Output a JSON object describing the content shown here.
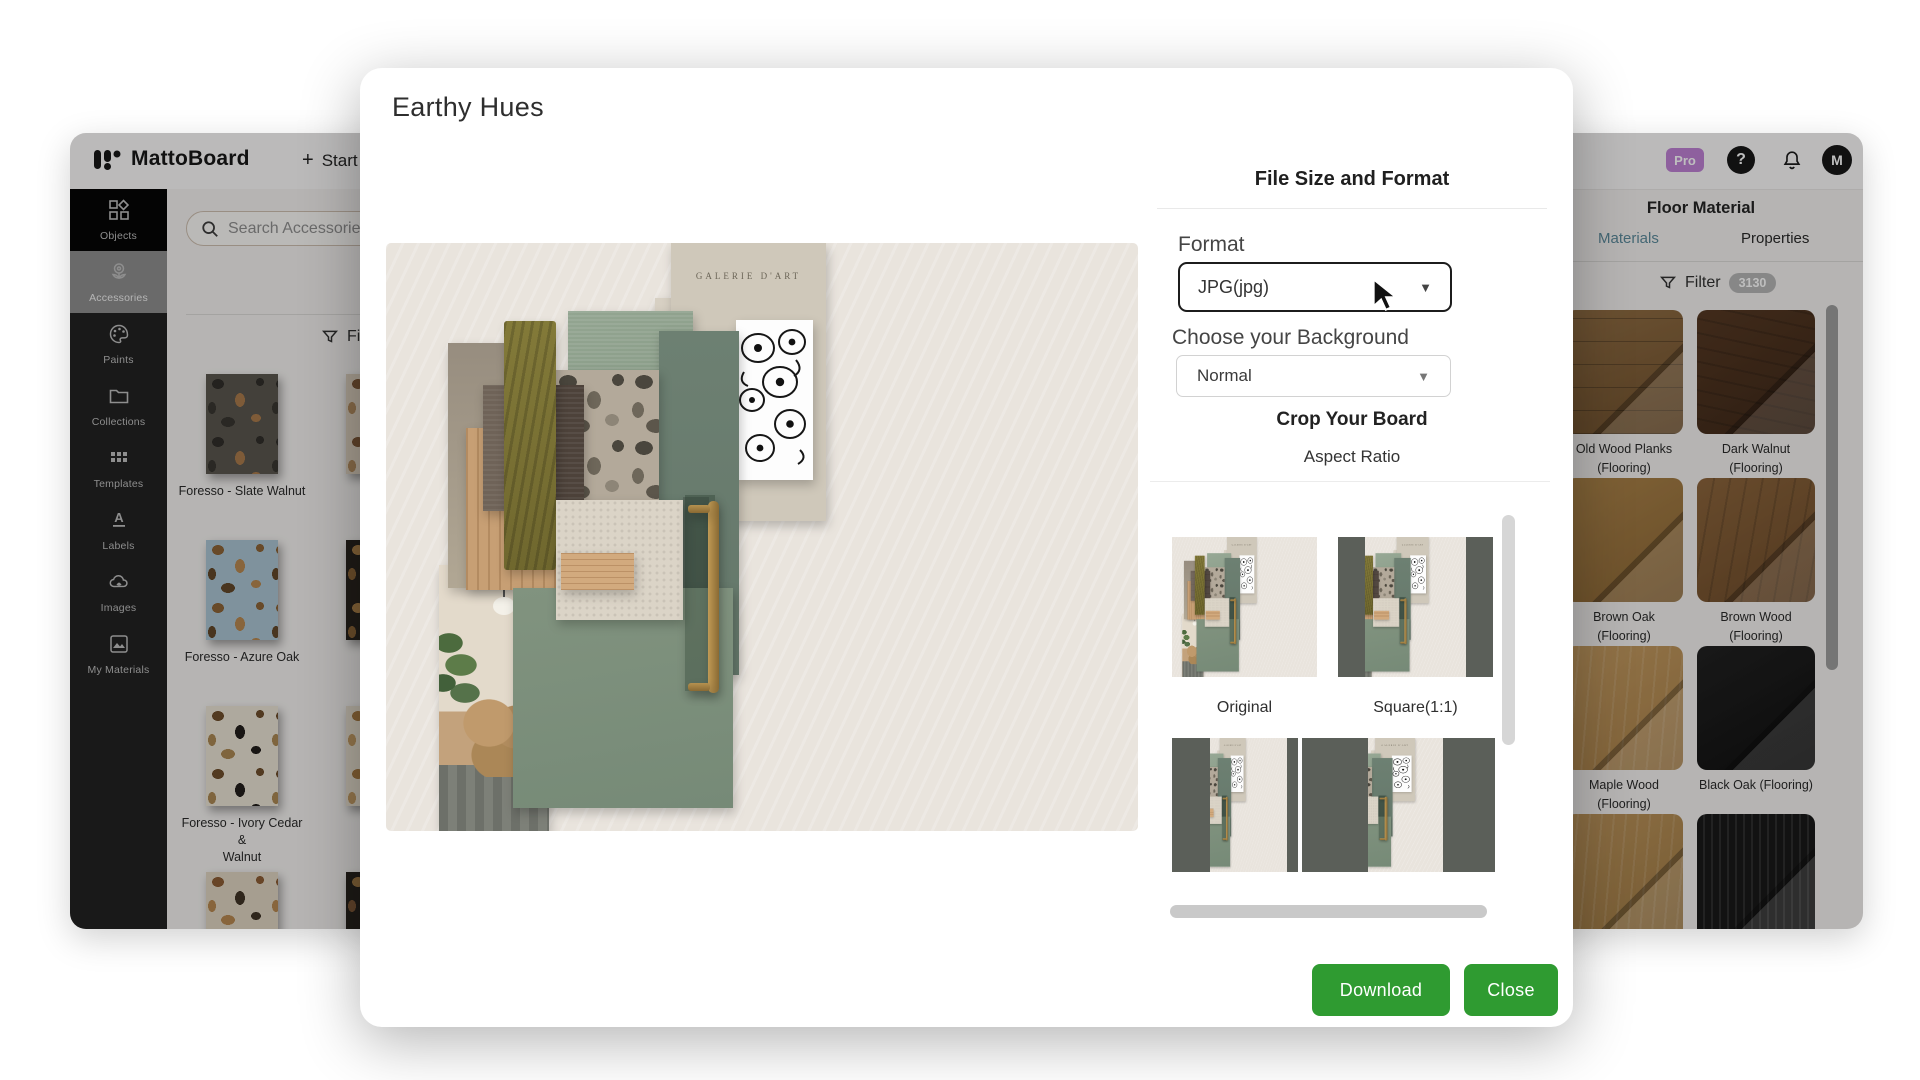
{
  "app": {
    "brand": "MattoBoard",
    "start_button": "Start",
    "pro_badge": "Pro",
    "avatar_initial": "M"
  },
  "sidebar": {
    "items": [
      {
        "id": "objects",
        "label": "Objects",
        "state": "active"
      },
      {
        "id": "accessories",
        "label": "Accessories",
        "state": "selected"
      },
      {
        "id": "paints",
        "label": "Paints",
        "state": ""
      },
      {
        "id": "collections",
        "label": "Collections",
        "state": ""
      },
      {
        "id": "templates",
        "label": "Templates",
        "state": ""
      },
      {
        "id": "labels",
        "label": "Labels",
        "state": ""
      },
      {
        "id": "images",
        "label": "Images",
        "state": ""
      },
      {
        "id": "my-materials",
        "label": "My Materials",
        "state": ""
      }
    ]
  },
  "accessories_panel": {
    "search_placeholder": "Search Accessories",
    "filter_label": "Filter",
    "filter_count": "119+",
    "products": [
      {
        "chip": "slate-walnut",
        "name_lines": [
          "Foresso - Slate Walnut"
        ]
      },
      {
        "chip": "white-terrazzo",
        "name_lines": [
          "Fores",
          "Lon"
        ]
      },
      {
        "chip": "azure-oak",
        "name_lines": [
          "Foresso - Azure Oak"
        ]
      },
      {
        "chip": "dark-terrazzo",
        "name_lines": [
          "Foress",
          "V"
        ]
      },
      {
        "chip": "ivory-cedar",
        "name_lines": [
          "Foresso - Ivory Cedar &",
          "Walnut"
        ]
      },
      {
        "chip": "white-terrazzo2",
        "name_lines": [
          "Fores"
        ]
      },
      {
        "chip": "brown-terrazzo",
        "name_lines": []
      },
      {
        "chip": "dark-terrazzo2",
        "name_lines": []
      }
    ]
  },
  "export_modal": {
    "title": "Earthy Hues",
    "section_heading": "File Size and Format",
    "format_label": "Format",
    "format_value": "JPG(jpg)",
    "background_label": "Choose your Background",
    "background_value": "Normal",
    "crop_heading": "Crop Your Board",
    "aspect_heading": "Aspect Ratio",
    "aspect_options": [
      {
        "label": "Original"
      },
      {
        "label": "Square(1:1)"
      }
    ],
    "download_button": "Download",
    "close_button": "Close"
  },
  "board": {
    "poster_text": "GALERIE D'ART"
  },
  "materials_panel": {
    "title": "Floor Material",
    "tabs": [
      {
        "label": "Materials",
        "active": true
      },
      {
        "label": "Properties",
        "active": false
      }
    ],
    "filter_label": "Filter",
    "filter_count": "3130",
    "materials": [
      {
        "swatch": "old-wood-planks",
        "name_lines": [
          "Old Wood Planks",
          "(Flooring)"
        ]
      },
      {
        "swatch": "dark-walnut",
        "name_lines": [
          "Dark Walnut",
          "(Flooring)"
        ]
      },
      {
        "swatch": "brown-oak",
        "name_lines": [
          "Brown Oak (Flooring)"
        ]
      },
      {
        "swatch": "brown-wood",
        "name_lines": [
          "Brown Wood",
          "(Flooring)"
        ]
      },
      {
        "swatch": "maple-wood",
        "name_lines": [
          "Maple Wood",
          "(Flooring)"
        ]
      },
      {
        "swatch": "black-oak",
        "name_lines": [
          "Black Oak (Flooring)"
        ]
      },
      {
        "swatch": "light-oak",
        "name_lines": []
      },
      {
        "swatch": "black-slats",
        "name_lines": []
      }
    ]
  },
  "colors": {
    "accent_green": "#2f9b31",
    "pro_purple": "#bd7fd4",
    "active_tab_teal": "#58889a",
    "sidebar_bg": "#1d1d1d"
  }
}
